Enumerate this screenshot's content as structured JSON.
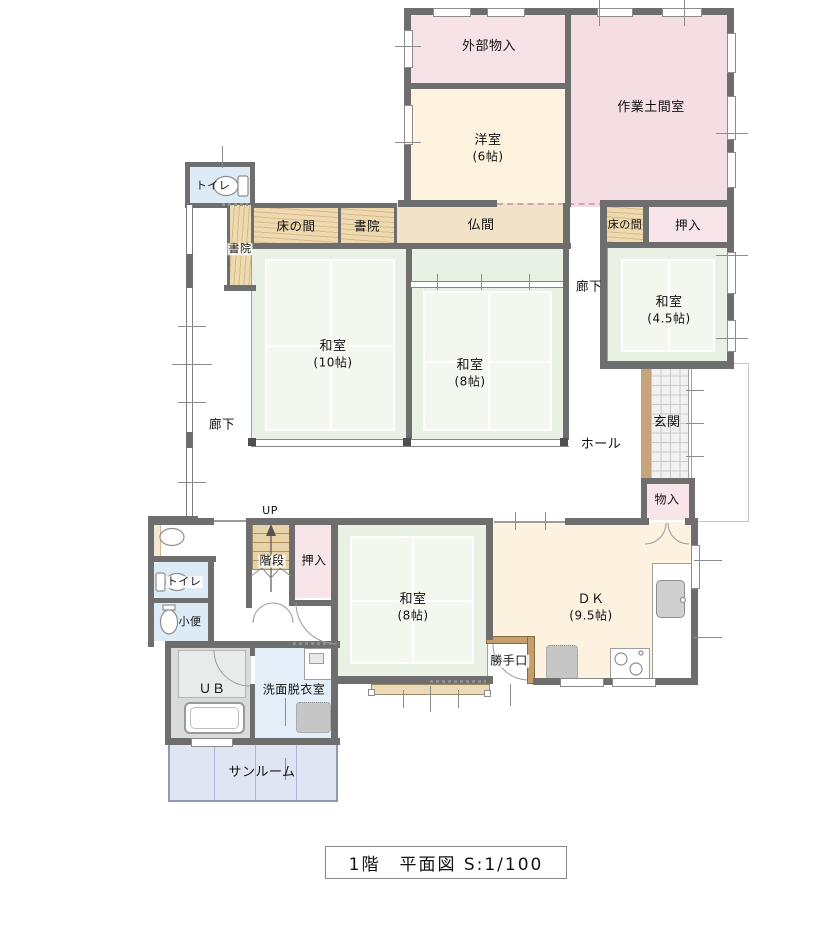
{
  "floorplan": {
    "caption": "1階　平面図 S:1/100",
    "labels": {
      "ext_storage": "外部物入",
      "work_room": "作業土間室",
      "western_name": "洋室",
      "western_size": "(6帖)",
      "toilet_upper": "トイレ",
      "tokonoma_left": "床の間",
      "shoin_side": "書院",
      "shoin_top": "書院",
      "butsuma": "仏間",
      "tokonoma_right": "床の間",
      "oshiire_upper": "押入",
      "washitsu10_name": "和室",
      "washitsu10_size": "(10帖)",
      "washitsu8c_name": "和室",
      "washitsu8c_size": "(8帖)",
      "washitsu45_name": "和室",
      "washitsu45_size": "(4.5帖)",
      "corridor_left": "廊下",
      "corridor_right": "廊下",
      "hall": "ホール",
      "entrance": "玄関",
      "storage_small": "物入",
      "up": "UP",
      "stairs": "階段",
      "oshiire_lower": "押入",
      "washitsu8b_name": "和室",
      "washitsu8b_size": "(8帖)",
      "dk_name": "ＤＫ",
      "dk_size": "(9.5帖)",
      "kitchen_door": "勝手口",
      "toilet_lower": "トイレ",
      "urinal": "小便",
      "bath": "ＵＢ",
      "washroom": "洗面脱衣室",
      "sunroom": "サンルーム"
    },
    "palette": {
      "wall": "#6e6e6e",
      "tatami_green": "#e9f1e4",
      "wood": "#eed9b0",
      "closet_pink": "#f8e5e9",
      "storage_pink": "#f6e2e7",
      "doma_pink": "#f4dee4",
      "room_cream": "#fdf3df",
      "butsuma_tan": "#f2e3c8",
      "water_blue": "#dcebf6",
      "bath_gray": "#d8dadb",
      "sunroom_blue": "#dfe5f3",
      "entrance_tile": "#f1f1f1",
      "kamachi_wood": "#c7a37b"
    }
  }
}
